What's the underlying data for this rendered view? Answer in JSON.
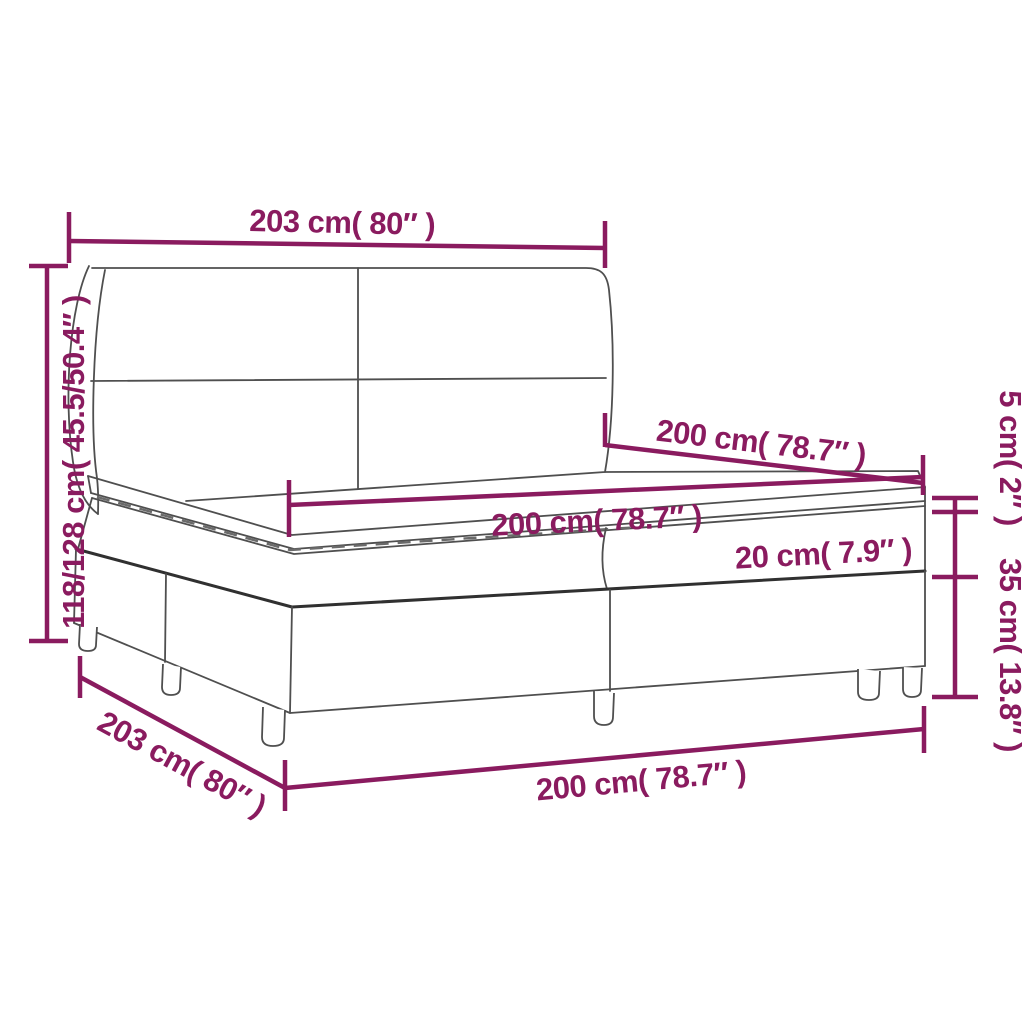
{
  "diagram": {
    "background_color": "#ffffff",
    "dimension_color": "#8a1b5f",
    "outline_color": "#4f4f4f",
    "labels": {
      "headboard_width_top": "203 cm( 80″ )",
      "total_height_left": "118/128 cm( 45.5/50.4″ )",
      "topper_height_right": "5 cm( 2″ )",
      "mattress_length_upper": "200 cm( 78.7″ )",
      "mattress_length_front": "200 cm( 78.7″ )",
      "mattress_height": "20 cm( 7.9″ )",
      "base_height_right": "35 cm( 13.8″ )",
      "base_width_bottom": "203 cm( 80″ )",
      "base_length_bottom": "200 cm( 78.7″ )"
    }
  }
}
